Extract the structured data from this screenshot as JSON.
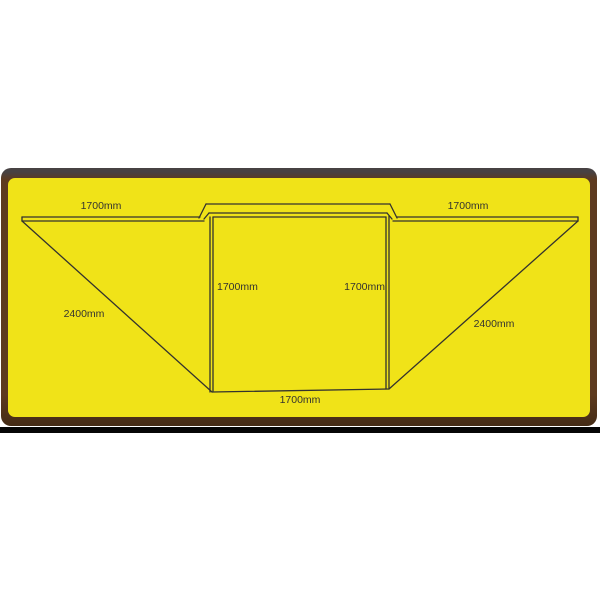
{
  "diagram": {
    "labels": {
      "left_wing_width": "1700mm",
      "right_wing_width": "1700mm",
      "center_left_depth": "1700mm",
      "center_right_depth": "1700mm",
      "center_bottom_width": "1700mm",
      "left_diagonal": "2400mm",
      "right_diagonal": "2400mm"
    },
    "colors": {
      "fabric_yellow": "#f0e318",
      "frame_brown": "#5d3a1f",
      "frame_top_gray": "#474243",
      "shadow_black": "#060606",
      "line": "#33322e",
      "text": "#333330"
    }
  }
}
